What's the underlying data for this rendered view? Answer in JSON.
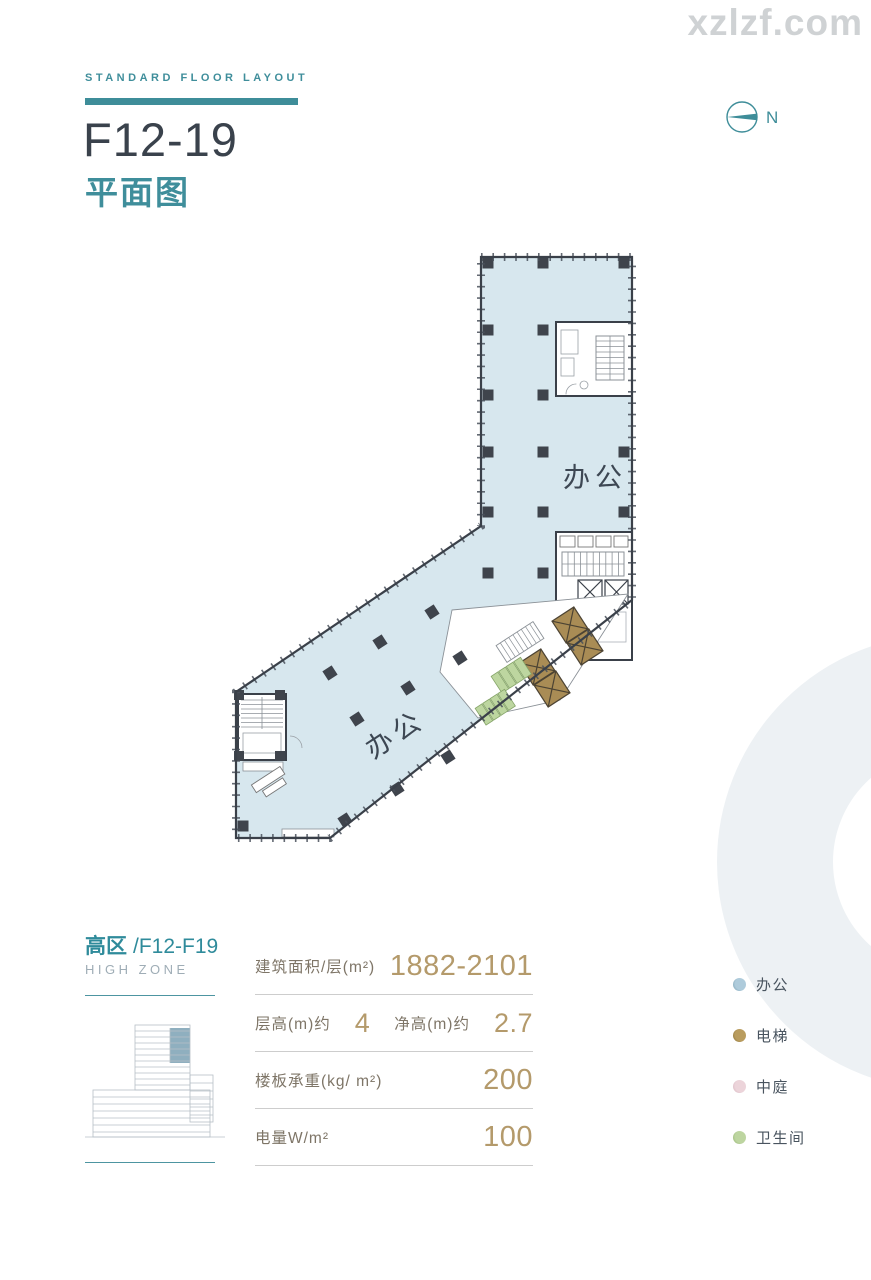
{
  "watermark": "xzlzf.com",
  "header": {
    "eyebrow": "STANDARD FLOOR LAYOUT",
    "title": "F12-19",
    "subtitle": "平面图"
  },
  "compass": {
    "north_label": "N"
  },
  "plan": {
    "upper_office_label": "办公",
    "lower_office_label": "办公"
  },
  "zone": {
    "name_cn": "高区",
    "floors": "/F12-F19",
    "name_en": "HIGH ZONE"
  },
  "specs": {
    "rows": [
      {
        "cells": [
          {
            "label": "建筑面积/层(m²)",
            "value": "1882-2101"
          }
        ]
      },
      {
        "cells": [
          {
            "label": "层高(m)约",
            "value": "4"
          },
          {
            "label": "净高(m)约",
            "value": "2.7"
          }
        ]
      },
      {
        "cells": [
          {
            "label": "楼板承重(kg/ m²)",
            "value": "200"
          }
        ]
      },
      {
        "cells": [
          {
            "label": "电量W/m²",
            "value": "100"
          }
        ]
      }
    ]
  },
  "legend": {
    "items": [
      {
        "label": "办公",
        "color": "#aecbdb",
        "shade": "#6f96a9"
      },
      {
        "label": "电梯",
        "color": "#b99c5e",
        "shade": "#7e6730"
      },
      {
        "label": "中庭",
        "color": "#ecd4da",
        "shade": "#d2afba"
      },
      {
        "label": "卫生间",
        "color": "#bdd5a0",
        "shade": "#8cab68"
      }
    ]
  },
  "colors": {
    "accent_teal": "#3e8d99",
    "value_gold": "#b49a6b",
    "plan_fill": "#d7e7ee",
    "elevator_gold": "#a98c55"
  }
}
